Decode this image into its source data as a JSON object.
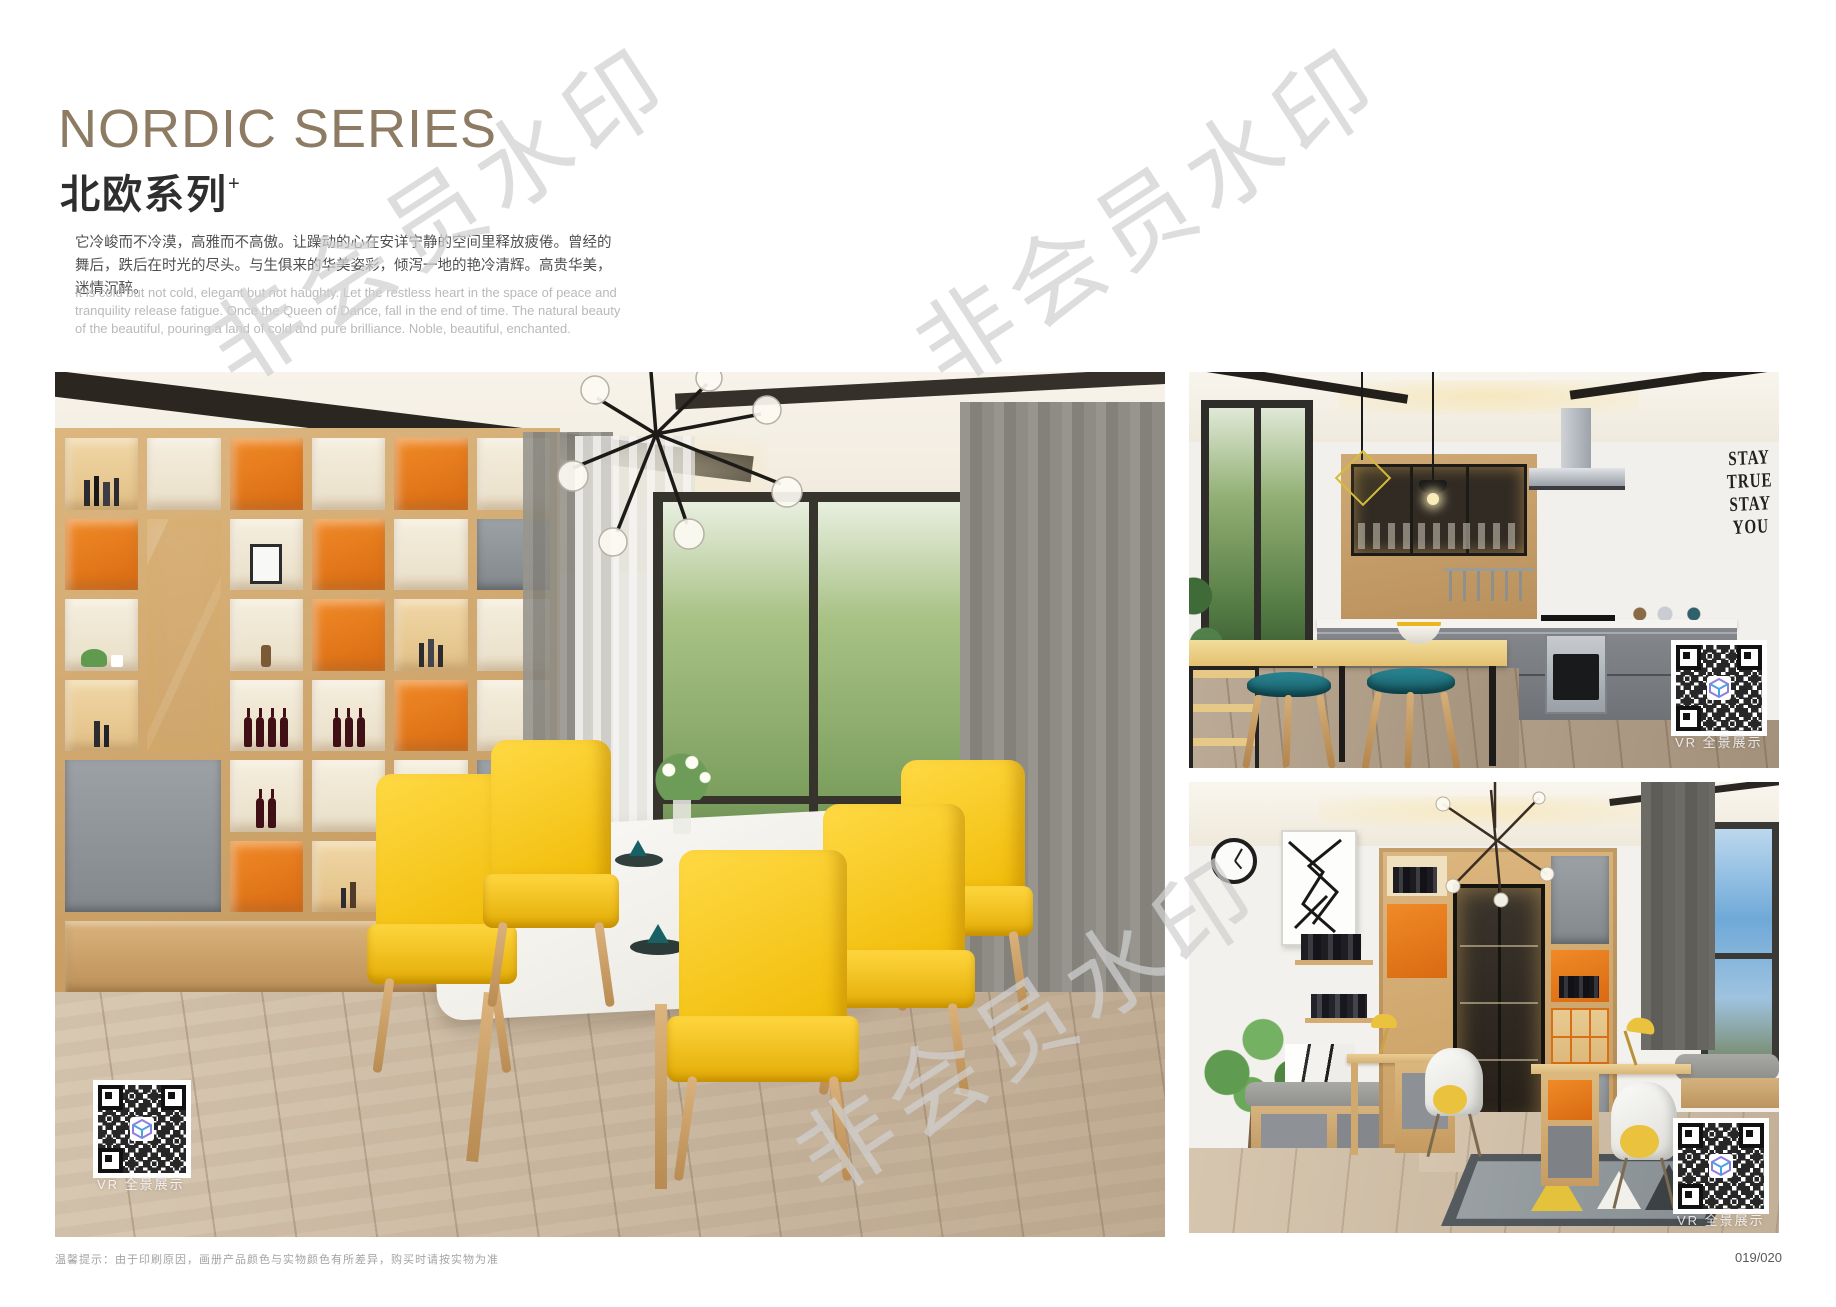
{
  "page": {
    "title_en": "NORDIC SERIES",
    "title_cn": "北欧系列",
    "title_sup": "+",
    "intro_cn": "它冷峻而不冷漠，高雅而不高傲。让躁动的心在安详宁静的空间里释放疲倦。曾经的舞后，跌后在时光的尽头。与生俱来的华美姿彩，倾泻一地的艳冷清辉。高贵华美，迷情沉醉。",
    "intro_en": "It is cold but not cold, elegant but not haughty. Let the restless heart in the space of peace and tranquility release fatigue. Once the Queen of Dance, fall in the end of time. The natural beauty of the beautiful, pouring a land of cold and pure brilliance. Noble, beautiful, enchanted.",
    "disclaimer": "温馨提示：由于印刷原因，画册产品颜色与实物颜色有所差异，购买时请按实物为准",
    "page_number": "019/020",
    "watermark": "非会员水印"
  },
  "photos": {
    "dining": {
      "vr_label": "VR 全景展示"
    },
    "kitchen": {
      "vr_label": "VR 全景展示",
      "wall_art_lines": [
        "STAY",
        "TRUE",
        "STAY",
        "YOU"
      ]
    },
    "study": {
      "vr_label": "VR 全景展示"
    }
  },
  "colors": {
    "title_taupe": "#8d7c63",
    "accent_orange": "#e0761c",
    "chair_yellow": "#f3c50a",
    "stool_teal": "#1e6e79",
    "wood_light": "#d9b887",
    "cabinet_gray": "#94989c"
  }
}
